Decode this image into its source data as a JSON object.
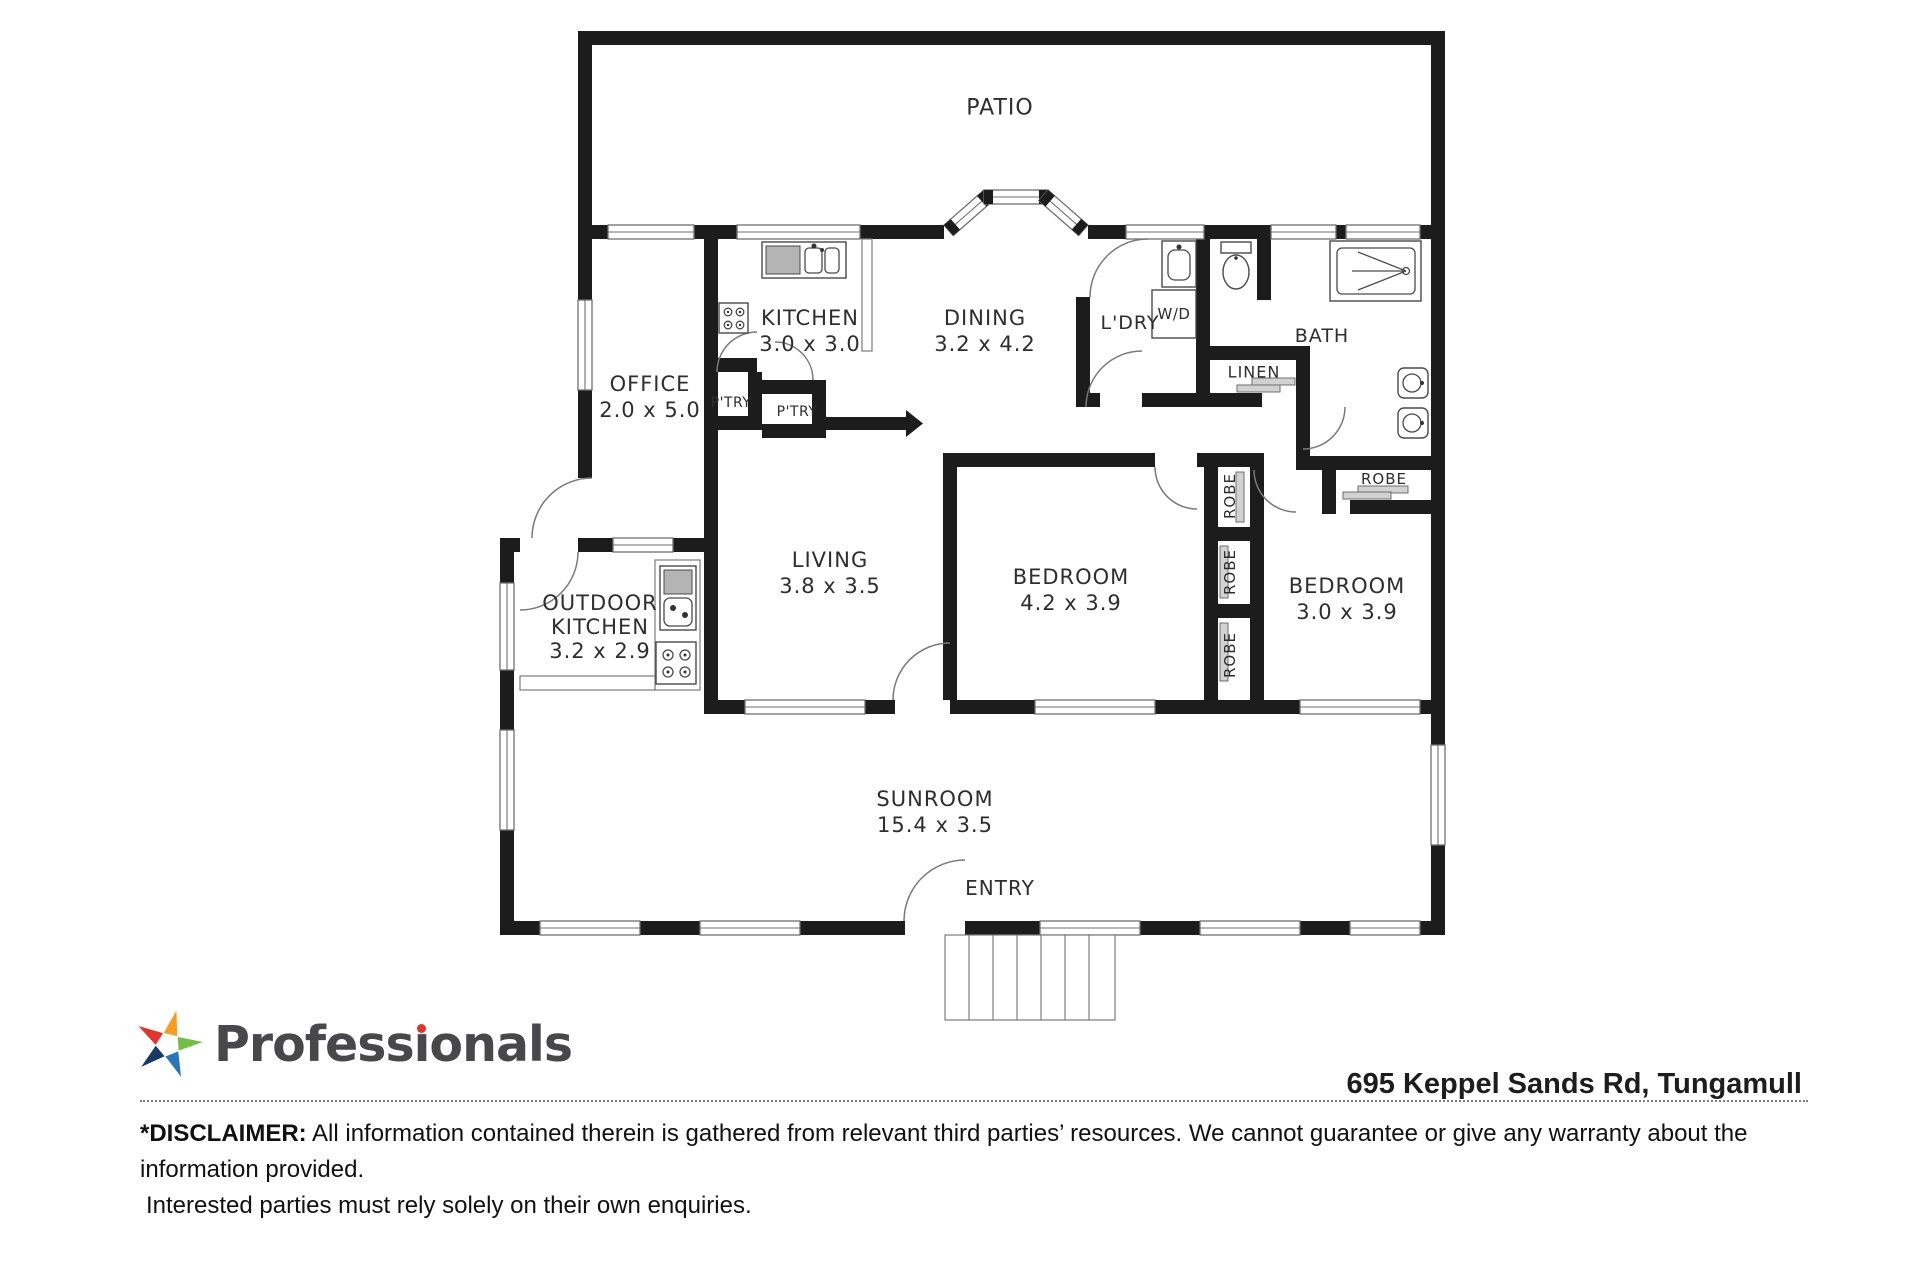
{
  "plan": {
    "patio": {
      "name": "PATIO"
    },
    "office": {
      "name": "OFFICE",
      "dims": "2.0 x 5.0"
    },
    "kitchen": {
      "name": "KITCHEN",
      "dims": "3.0 x 3.0"
    },
    "dining": {
      "name": "DINING",
      "dims": "3.2 x 4.2"
    },
    "laundry": {
      "name": "L'DRY"
    },
    "washer_dryer": {
      "name": "W/D"
    },
    "bath": {
      "name": "BATH"
    },
    "linen": {
      "name": "LINEN"
    },
    "pantry1": {
      "name": "P'TRY"
    },
    "pantry2": {
      "name": "P'TRY"
    },
    "living": {
      "name": "LIVING",
      "dims": "3.8 x 3.5"
    },
    "bedroom1": {
      "name": "BEDROOM",
      "dims": "4.2 x 3.9"
    },
    "bedroom2": {
      "name": "BEDROOM",
      "dims": "3.0 x 3.9"
    },
    "robe_bath": {
      "name": "ROBE"
    },
    "robe1": {
      "name": "ROBE"
    },
    "robe2": {
      "name": "ROBE"
    },
    "robe3": {
      "name": "ROBE"
    },
    "outdoor_kitchen": {
      "line1": "OUTDOOR",
      "line2": "KITCHEN",
      "dims": "3.2 x 2.9"
    },
    "sunroom": {
      "name": "SUNROOM",
      "dims": "15.4 x 3.5"
    },
    "entry": {
      "name": "ENTRY"
    }
  },
  "footer": {
    "brand": {
      "name": "Professionals",
      "name_pre": "Profess",
      "name_i": "ı",
      "name_post": "onals"
    },
    "address": "695 Keppel Sands Rd, Tungamull",
    "disclaimer": {
      "label": "*DISCLAIMER:",
      "line1": "All information contained therein is gathered from relevant third parties’ resources. We cannot guarantee or give any warranty about the information provided.",
      "line2": "Interested parties must rely solely on their own enquiries."
    },
    "star_colors": {
      "red": "#e2342b",
      "orange": "#f89c1c",
      "green": "#71bf44",
      "blue": "#2a76bd",
      "navy": "#173963"
    }
  }
}
